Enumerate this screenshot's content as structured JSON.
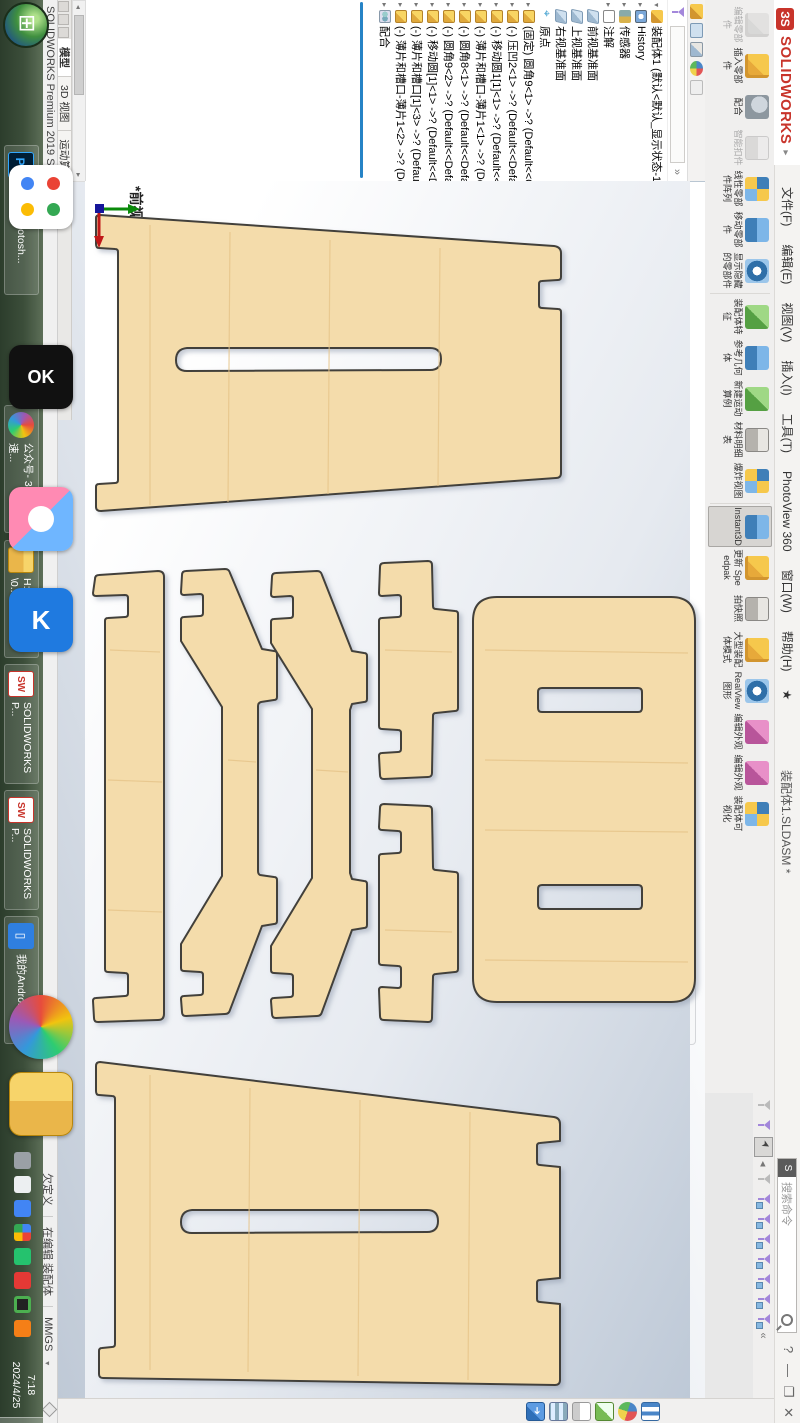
{
  "colors": {
    "wood": "#f4dcab",
    "wood_grain": "#e6c489",
    "outline": "#43413a",
    "accent_blue": "#2683c6",
    "logo_red": "#c8342b",
    "taskbar_green": "#3c4e3a"
  },
  "window": {
    "logo_mark": "ЗS",
    "logo_word": "SOLIDWORKS",
    "collapse_caret": "▸",
    "menus": [
      {
        "label": "文件(F)"
      },
      {
        "label": "编辑(E)"
      },
      {
        "label": "视图(V)"
      },
      {
        "label": "插入(I)"
      },
      {
        "label": "工具(T)"
      },
      {
        "label": "PhotoView 360"
      },
      {
        "label": "窗口(W)"
      },
      {
        "label": "帮助(H)"
      },
      {
        "label": "★"
      }
    ],
    "title": "装配体1.SLDASM *",
    "search_placeholder": "搜索命令",
    "help_button": "?",
    "buttons": {
      "minimize": "—",
      "restore": "❐",
      "close": "✕"
    },
    "filter_collapse": "«",
    "cm_end_restore": "❐",
    "cm_end_close": "✕"
  },
  "command_manager": {
    "tabs": [
      {
        "label": "装配体",
        "active": true
      },
      {
        "label": "布局"
      },
      {
        "label": "草图"
      },
      {
        "label": "评估"
      },
      {
        "label": "渲染工具"
      },
      {
        "label": "直接编辑"
      },
      {
        "label": "MBD"
      },
      {
        "label": "SOLIDWORKS 插件"
      }
    ],
    "buttons": [
      {
        "label": "编辑零部件",
        "state": "disabled"
      },
      {
        "label": "插入零部件",
        "dropdown": "▾"
      },
      {
        "label": "配合"
      },
      {
        "label": "智能扣件",
        "state": "disabled"
      },
      {
        "label": "线性零部件阵列",
        "dropdown": "▾"
      },
      {
        "label": "移动零部件",
        "dropdown": "▾"
      },
      {
        "label": "显示隐藏的零部件"
      },
      {
        "label": "装配体特征",
        "dropdown": "▾"
      },
      {
        "label": "参考几何体",
        "dropdown": "▾"
      },
      {
        "label": "新建运动算例",
        "dropdown": "▾"
      },
      {
        "label": "材料明细表"
      },
      {
        "label": "爆炸视图",
        "dropdown": "▾"
      },
      {
        "label": "Instant3D",
        "state": "active"
      },
      {
        "label": "更新 Speedpak"
      },
      {
        "label": "拍快照"
      },
      {
        "label": "大型装配体模式"
      },
      {
        "label": "RealView 图形"
      },
      {
        "label": "编辑外观"
      },
      {
        "label": "编辑外观",
        "dropdown": "▾"
      },
      {
        "label": "装配体可视化"
      }
    ]
  },
  "feature_tree": {
    "root": "装配体1 (默认<默认_显示状态-1>)",
    "items": [
      {
        "label": "History",
        "icon": "history"
      },
      {
        "label": "传感器",
        "icon": "sensor"
      },
      {
        "label": "注解",
        "icon": "note"
      },
      {
        "label": "前视基准面",
        "icon": "plane"
      },
      {
        "label": "上视基准面",
        "icon": "plane"
      },
      {
        "label": "右视基准面",
        "icon": "plane"
      },
      {
        "label": "原点",
        "icon": "origin"
      },
      {
        "label": "(固定) 圆角9<1> ->? (Default<<C",
        "icon": "part"
      },
      {
        "label": "(-) 压凹2<1> ->? (Default<<Defa",
        "icon": "part"
      },
      {
        "label": "(-) 移动圆1[1]<1> ->? (Default<<",
        "icon": "part"
      },
      {
        "label": "(-) 薄片和槽口-薄片1<1> ->? (Def",
        "icon": "part"
      },
      {
        "label": "(-) 圆角8<1> ->? (Default<<Defa",
        "icon": "part"
      },
      {
        "label": "(-) 圆角9<2> ->? (Default<<Defa",
        "icon": "part"
      },
      {
        "label": "(-) 移动圆[1]<1> ->? (Default<<Def",
        "icon": "part"
      },
      {
        "label": "(-) 薄片和槽口[1]<3> ->? (Default<",
        "icon": "part"
      },
      {
        "label": "(-) 薄片和槽口-薄片1<2> ->? (Def",
        "icon": "part"
      },
      {
        "label": "配合",
        "icon": "mate"
      }
    ]
  },
  "headsup_icons": [
    "zoom-to-fit",
    "zoom-to-area",
    "previous-view",
    "section-view",
    "dynamic-annotation",
    "view-orientation",
    "display-style",
    "hide-show-items",
    "edit-appearance",
    "apply-scene",
    "view-settings"
  ],
  "graphics": {
    "view_label": "*前视"
  },
  "task_pane_icons": [
    "solidworks-resources",
    "design-library",
    "file-explorer",
    "view-palette",
    "appearances-scenes-decals",
    "custom-properties"
  ],
  "status_bar": {
    "left": "SOLIDWORKS Premium 2019 SP5.0",
    "define_state": "欠定义",
    "editing": "在编辑 装配体",
    "units": "MMGS",
    "units_caret": "▾"
  },
  "model_tabs": [
    {
      "label": "模型",
      "active": true
    },
    {
      "label": "3D 视图"
    },
    {
      "label": "运动算例1"
    }
  ],
  "taskbar": {
    "buttons": [
      {
        "label": "Adobe Photosh...",
        "icon": "Ps"
      },
      {
        "label": "公众号- 360极速...",
        "icon": "360"
      },
      {
        "label": "H:\\微信公众号\\0...",
        "icon": "folder"
      },
      {
        "label": "SOLIDWORKS P...",
        "icon": "SW"
      },
      {
        "label": "SOLIDWORKS P...",
        "icon": "SW"
      },
      {
        "label": "我的Android手机",
        "icon": "phone"
      }
    ],
    "tray_icons": [
      "laptop",
      "uparrow",
      "sogou",
      "files",
      "green-dot",
      "red-dot",
      "record",
      "orange-dot"
    ],
    "clock": "7:18",
    "date": "2024/4/25"
  },
  "parts": {
    "top_panel": {
      "d": "M96 218 Q96 215 100 215 L554 246 Q561 247 561 253 L561 277 Q561 280 558 280 L542 281 Q539 281 539 284 L539 305 Q539 308 542 308 L558 309 Q561 309 561 312 L561 473 Q561 478 556 478 L101 511 Q96 511 96 507 L96 487 Q96 484 99 484 L115 483 Q118 483 118 480 L118 252 Q118 249 115 249 L99 248 Q96 248 96 244 Z M187 348 Q176 349 176 360 Q176 371 187 371 L430 370 Q441 370 441 359 Q441 348 430 348 Z"
    },
    "bottom_panel": {
      "d": "M96 1066 Q96 1062 100 1062 L554 1117 Q560 1118 560 1124 L560 1141 L540 1143 Q537 1143 537 1146 L537 1162 Q537 1165 540 1165 L560 1167 L560 1278 L540 1280 Q537 1280 537 1283 L537 1299 Q537 1302 540 1302 L560 1304 L560 1380 Q560 1385 555 1385 L103 1378 Q99 1378 99 1374 L99 1351 Q99 1348 102 1348 L112 1347 Q115 1347 115 1344 L115 1099 Q115 1096 112 1096 L99 1095 Q96 1095 96 1091 Z M192 1210 Q181 1211 181 1222 Q181 1233 192 1233 L427 1232 Q438 1232 438 1221 Q438 1210 427 1210 Z"
    },
    "strip_leg": {
      "d": "M95 579 Q95 575 99 575 L158 571 Q164 571 164 577 L164 1014 Q164 1020 158 1020 L98 1022 Q94 1022 94 1018 L93 1001 Q93 998 96 998 L125 996 Q128 996 128 993 L128 976 Q128 973 125 973 L108 972 Q105 972 105 969 L105 621 Q105 618 108 618 L125 617 Q128 617 128 614 L128 598 Q128 595 125 595 L96 596 Q93 596 93 593 Z"
    },
    "bone_left": {
      "d": "M182 575 Q182 571 186 571 L225 569 Q229 569 230 573 L262 649 L274 651 Q277 651 277 654 L277 697 Q277 700 274 700 L261 702 Q258 703 258 706 L258 871 Q258 874 260 875 L274 877 Q277 877 277 880 L277 921 Q277 924 274 924 L262 926 L230 1010 Q229 1014 225 1014 L186 1016 Q182 1016 182 1012 L181 999 Q181 996 184 996 L200 995 Q203 995 203 992 L203 975 Q203 972 200 972 L184 971 Q181 971 181 968 L181 944 L222 876 L222 707 L181 641 L181 620 Q181 617 184 617 L200 616 Q203 616 203 613 L203 597 Q203 594 200 594 L184 595 Q181 595 181 592 Z"
    },
    "bone_right": {
      "d": "M272 577 Q272 573 276 573 L317 571 Q321 571 322 575 L352 651 L364 653 Q367 653 367 656 L367 699 Q367 702 364 702 L352 704 L350 710 L350 873 L352 879 L364 881 Q367 881 367 884 L367 925 Q367 928 364 928 L352 930 L322 1012 Q321 1016 317 1016 L276 1018 Q272 1018 272 1014 L271 1001 Q271 998 274 998 L290 997 Q293 997 293 994 L293 977 Q293 974 290 974 L274 973 Q271 973 271 970 L271 946 L312 878 L312 709 L271 643 L271 622 Q271 619 274 619 L290 618 Q293 618 293 615 L293 599 Q293 596 290 596 L274 597 Q271 597 271 594 Z"
    },
    "small_upper": {
      "d": "M380 567 Q380 563 384 563 L428 561 Q432 561 432 565 L433 606 Q433 609 436 609 L455 611 Q458 611 458 614 L458 708 Q458 711 455 711 L436 713 Q433 713 433 716 L432 773 Q432 777 428 777 L384 779 Q380 779 380 775 L379 756 Q379 753 382 753 L398 752 Q401 752 401 749 L401 733 Q401 730 398 730 L382 729 Q379 729 379 726 L379 621 Q379 618 382 618 L398 617 Q401 617 401 614 L401 598 Q401 595 398 595 L382 596 Q379 596 379 593 Z"
    },
    "small_lower": {
      "d": "M380 1016 Q380 1020 384 1020 L428 1022 Q432 1022 432 1018 L433 977 Q433 974 436 974 L455 972 Q458 972 458 969 L458 875 Q458 872 455 872 L436 870 Q433 870 433 867 L432 810 Q432 806 428 806 L384 804 Q380 804 380 808 L379 827 Q379 830 382 830 L398 831 Q401 831 401 834 L401 850 Q401 853 398 853 L382 854 Q379 854 379 857 L379 962 Q379 965 382 965 L398 966 Q401 966 401 969 L401 985 Q401 988 398 988 L382 987 Q379 987 379 990 Z"
    },
    "seat": {
      "d": "M497 597 Q473 597 473 621 L473 978 Q473 1002 497 1002 L671 1002 Q695 1002 695 978 L695 621 Q695 597 671 597 Z M542 688 L638 688 Q642 688 642 692 L642 708 Q642 712 638 712 L542 712 Q538 712 538 708 L538 692 Q538 688 542 688 Z M542 885 L638 885 Q642 885 642 889 L642 905 Q642 909 638 909 L542 909 Q538 909 538 905 L538 889 Q538 885 542 885 Z"
    }
  }
}
